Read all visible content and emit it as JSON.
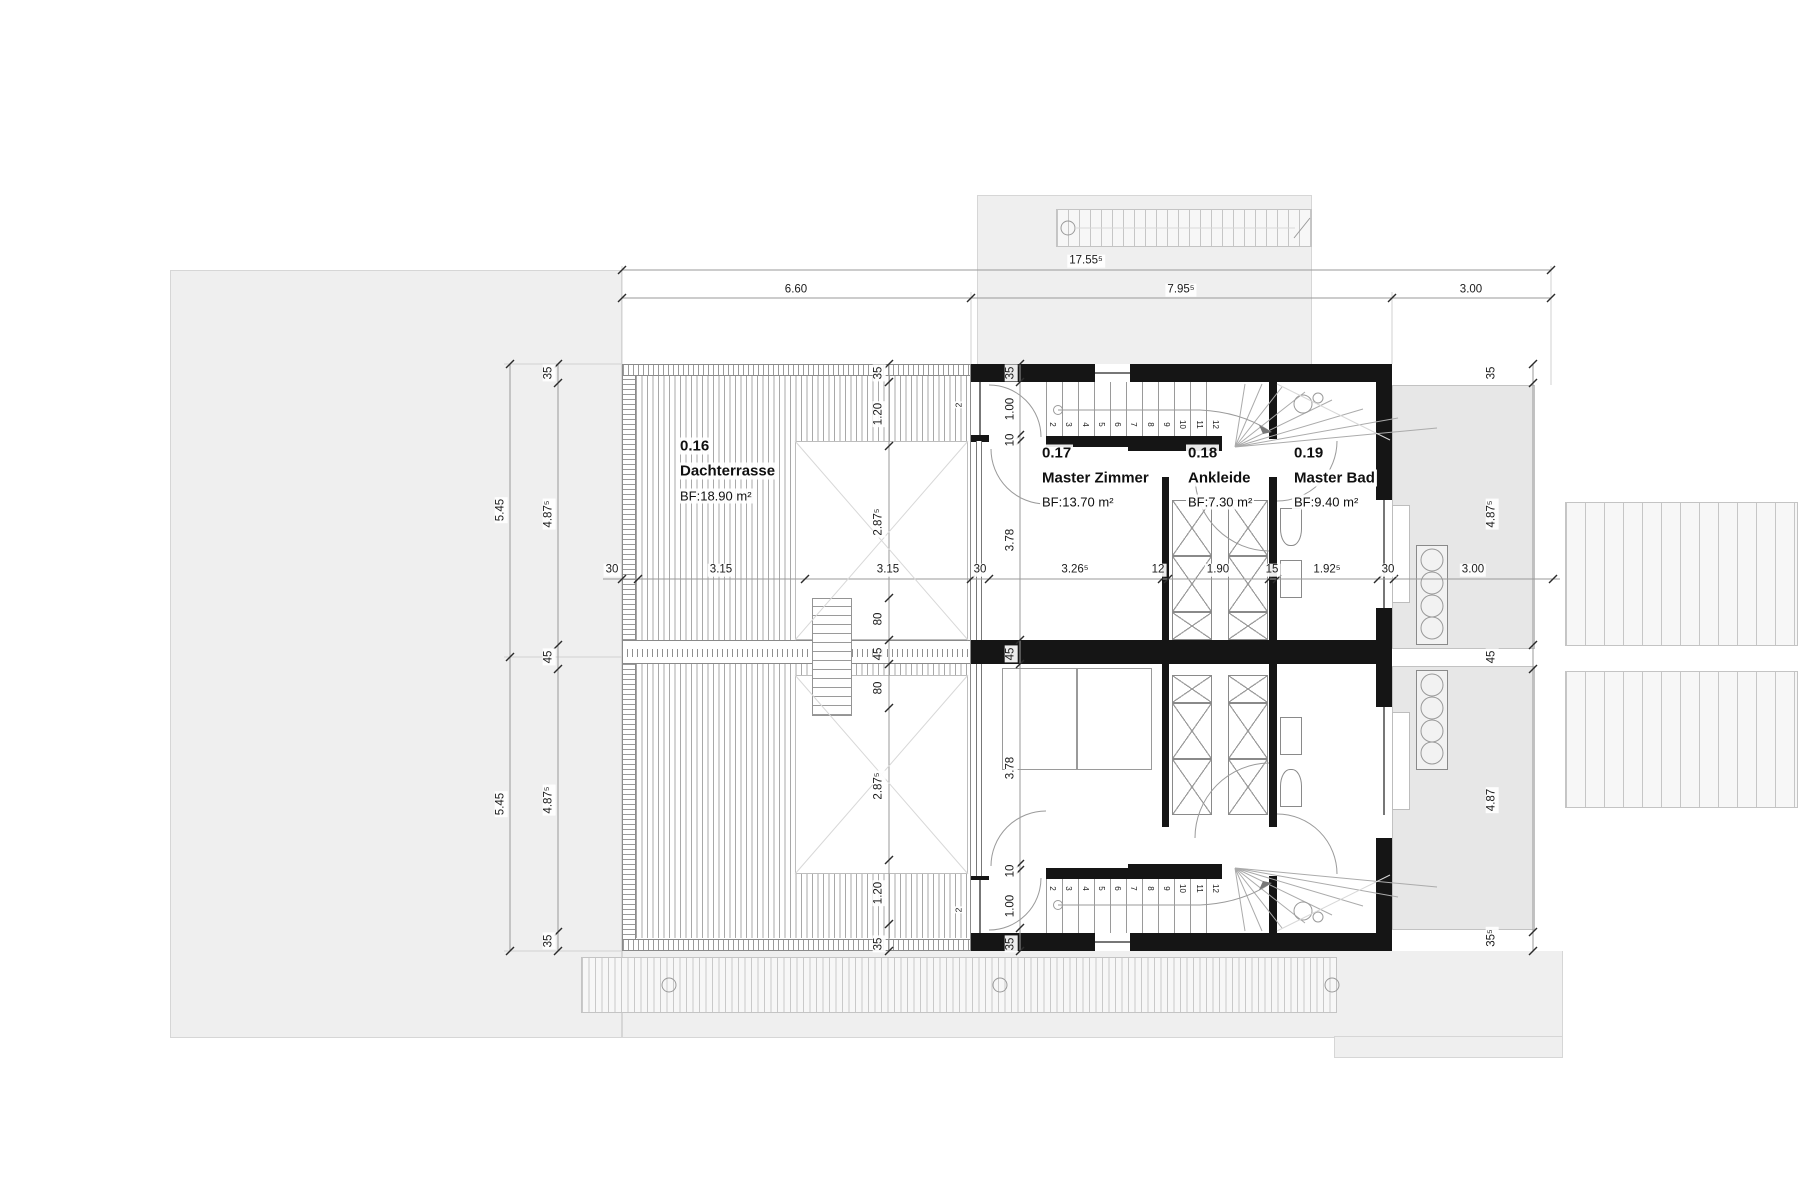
{
  "rooms": [
    {
      "id": "0.16",
      "name": "Dachterrasse",
      "area": "BF:18.90 m²"
    },
    {
      "id": "0.17",
      "name": "Master Zimmer",
      "area": "BF:13.70 m²"
    },
    {
      "id": "0.18",
      "name": "Ankleide",
      "area": "BF:7.30 m²"
    },
    {
      "id": "0.19",
      "name": "Master Bad",
      "area": "BF:9.40 m²"
    }
  ],
  "dims": {
    "top_total": "17.55⁵",
    "top_terrace": "6.60",
    "top_house": "7.95⁵",
    "top_balcony": "3.00",
    "mid": [
      "30",
      "3.15",
      "3.15",
      "30",
      "3.26⁵",
      "12",
      "1.90",
      "15",
      "1.92⁵",
      "30",
      "3.00"
    ],
    "left_outer": [
      "5.45",
      "5.45"
    ],
    "left_inner": [
      "35",
      "4.87⁵",
      "45",
      "4.87⁵",
      "35"
    ],
    "right": [
      "35",
      "4.87⁵",
      "45",
      "4.87",
      "35⁵"
    ],
    "terrace": [
      "35",
      "1.20",
      "2.87⁵",
      "80",
      "45",
      "80",
      "2.87⁵",
      "1.20",
      "35"
    ],
    "house": [
      "35",
      "1.00",
      "10",
      "3.78",
      "45",
      "3.78",
      "10",
      "1.00",
      "35"
    ],
    "step_marks": [
      "2",
      "2"
    ]
  },
  "stairs": {
    "upper_numbers": [
      "2",
      "3",
      "4",
      "5",
      "6",
      "7",
      "8",
      "9",
      "10",
      "11",
      "12"
    ],
    "lower_numbers": [
      "2",
      "3",
      "4",
      "5",
      "6",
      "7",
      "8",
      "9",
      "10",
      "11",
      "12"
    ]
  },
  "colors": {
    "wall": "#151515",
    "outdoor": "#efefef",
    "balcony": "#e7e7e7",
    "linework": "#9a9a9a"
  }
}
